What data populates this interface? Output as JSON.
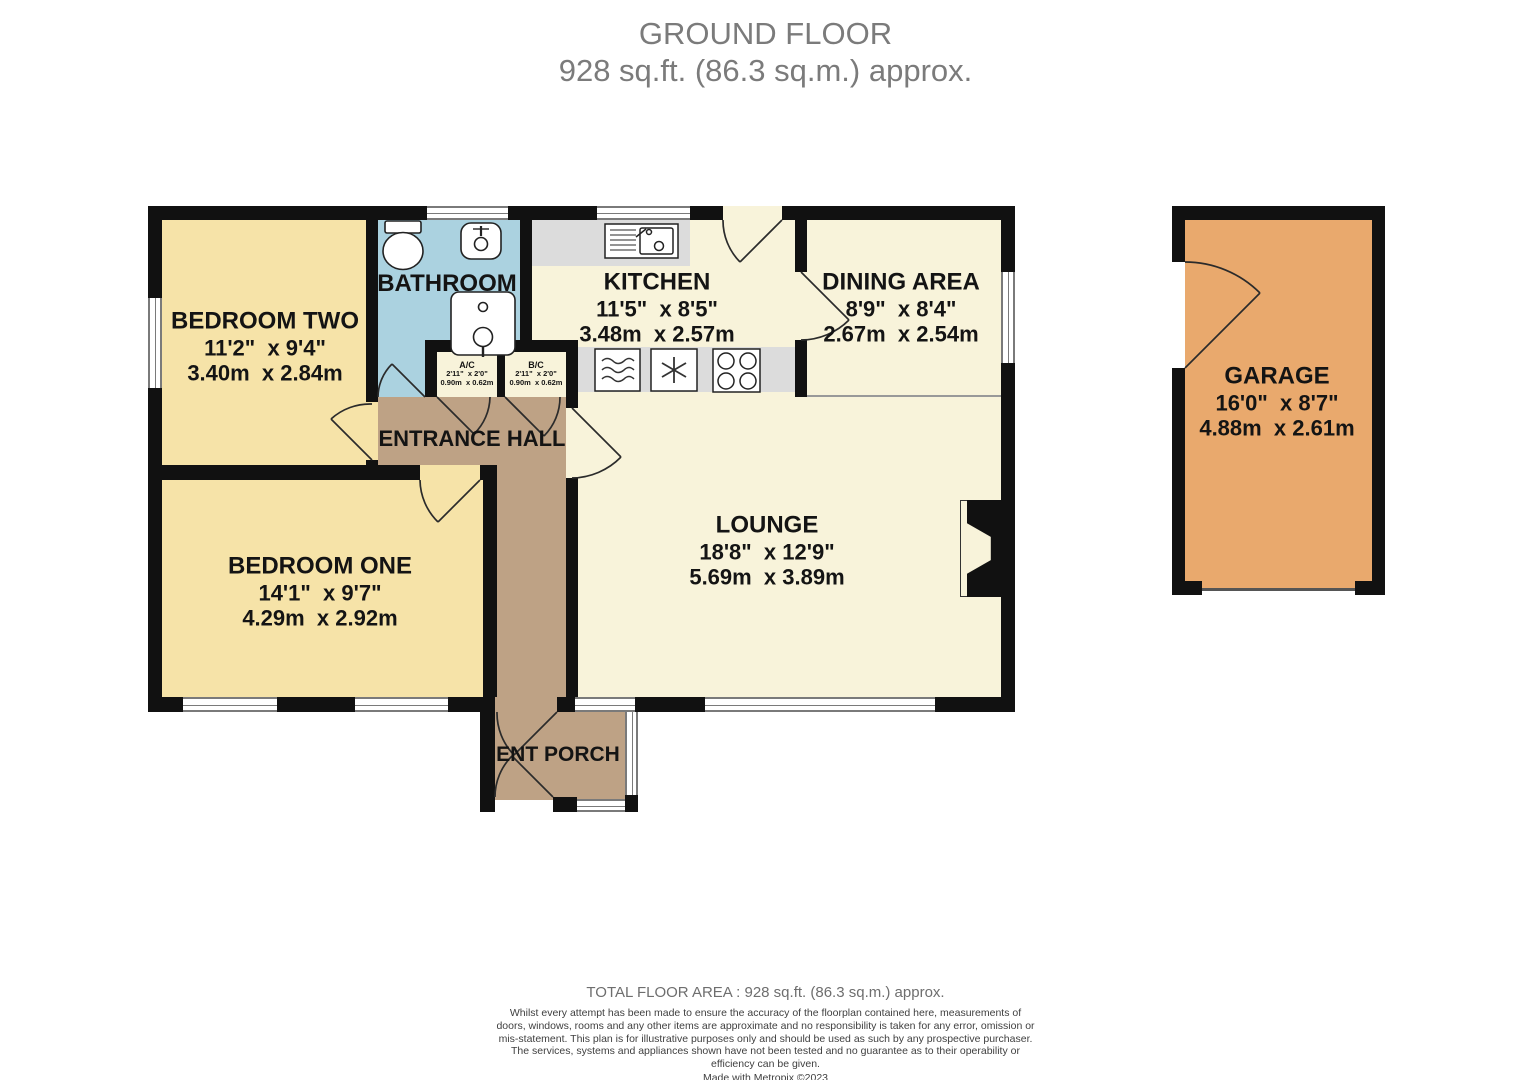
{
  "title": {
    "line1": "GROUND FLOOR",
    "line2": "928 sq.ft. (86.3 sq.m.) approx."
  },
  "rooms": {
    "bedroom_two": {
      "name": "BEDROOM TWO",
      "imperial": "11'2\"  x 9'4\"",
      "metric": "3.40m  x 2.84m"
    },
    "bathroom": {
      "name": "BATHROOM"
    },
    "kitchen": {
      "name": "KITCHEN",
      "imperial": "11'5\"  x 8'5\"",
      "metric": "3.48m  x 2.57m"
    },
    "dining_area": {
      "name": "DINING AREA",
      "imperial": "8'9\"  x 8'4\"",
      "metric": "2.67m  x 2.54m"
    },
    "entrance_hall": {
      "name": "ENTRANCE HALL"
    },
    "airing_cupboard": {
      "name": "A/C",
      "imperial": "2'11\"  x 2'0\"",
      "metric": "0.90m  x 0.62m"
    },
    "boiler_cupboard": {
      "name": "B/C",
      "imperial": "2'11\"  x 2'0\"",
      "metric": "0.90m  x 0.62m"
    },
    "bedroom_one": {
      "name": "BEDROOM ONE",
      "imperial": "14'1\"  x 9'7\"",
      "metric": "4.29m  x 2.92m"
    },
    "lounge": {
      "name": "LOUNGE",
      "imperial": "18'8\"  x 12'9\"",
      "metric": "5.69m  x 3.89m"
    },
    "ent_porch": {
      "name": "ENT PORCH"
    },
    "garage": {
      "name": "GARAGE",
      "imperial": "16'0\"  x 8'7\"",
      "metric": "4.88m  x 2.61m"
    }
  },
  "icons": [
    "toilet-icon",
    "basin-icon",
    "bath-icon",
    "kitchen-sink-icon",
    "oven-icon",
    "freezer-icon",
    "hob-icon",
    "fireplace-icon",
    "door-swing"
  ],
  "colors": {
    "wall": "#111111",
    "bedroom_fill": "#f6e3a8",
    "living_fill": "#f8f3da",
    "bathroom_fill": "#abd2e0",
    "hall_fill": "#bea285",
    "garage_fill": "#e9a96d",
    "counter_fill": "#dcdcdc",
    "title_text": "#7b7b7b",
    "label_text": "#141414"
  },
  "footer": {
    "total_area": "TOTAL FLOOR AREA : 928 sq.ft. (86.3 sq.m.) approx.",
    "disclaimer": "Whilst every attempt has been made to ensure the accuracy of the floorplan contained here, measurements of doors, windows, rooms and any other items are approximate and no responsibility is taken for any error, omission or mis-statement. This plan is for illustrative purposes only and should be used as such by any prospective purchaser. The services, systems and appliances shown have not been tested and no guarantee as to their operability or efficiency can be given.",
    "credit": "Made with Metropix ©2023"
  }
}
